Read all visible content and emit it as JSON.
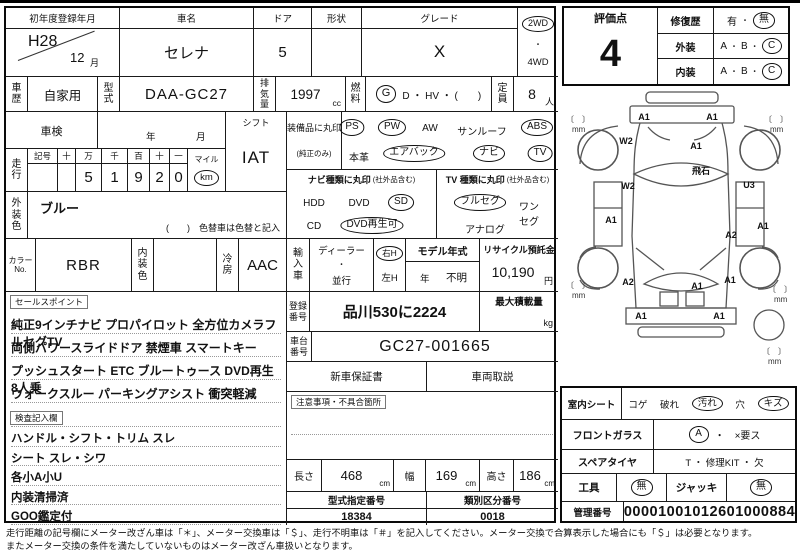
{
  "header": {
    "reg_label": "初年度登録年月",
    "reg_year": "H28",
    "reg_month": "12",
    "reg_month_unit": "月",
    "name_label": "車名",
    "name": "セレナ",
    "door_label": "ドア",
    "door": "5",
    "shape_label": "形状",
    "shape": "",
    "grade_label": "グレード",
    "grade": "X",
    "drive_top": "2WD",
    "drive_sep": "・",
    "drive_bottom": "4WD"
  },
  "row2": {
    "history_label": "車歴",
    "history": "自家用",
    "model_code_label": "型式",
    "model_code": "DAA-GC27",
    "displacement_label": "排気量",
    "displacement": "1997",
    "displacement_unit": "cc",
    "fuel_label": "燃料",
    "fuel_marked": "G",
    "fuel_rest": "D ・ HV ・ (　　)",
    "capacity_label": "定員",
    "capacity": "8",
    "capacity_unit": "人"
  },
  "inspection": {
    "label": "車検",
    "year_unit": "年",
    "month_unit": "月"
  },
  "shift": {
    "label": "シフト",
    "value": "IAT"
  },
  "mileage": {
    "label": "走行",
    "headers": [
      "記号",
      "十",
      "万",
      "千",
      "百",
      "十",
      "一"
    ],
    "digits": [
      "",
      "",
      "5",
      "1",
      "9",
      "2",
      "0"
    ],
    "mile_label": "マイル",
    "km_label": "km"
  },
  "body_color": {
    "label": "外装色",
    "value": "ブルー",
    "note": "(　　)　色替車は色替と記入"
  },
  "color_row": {
    "color_no_label": "カラーNo.",
    "color_no": "RBR",
    "interior_label": "内装色",
    "interior": "",
    "ac_label": "冷房",
    "ac": "AAC"
  },
  "equipment": {
    "label": "装備品に丸印",
    "label_note": "(純正のみ)",
    "row1": [
      {
        "label": "PS",
        "marked": true
      },
      {
        "label": "PW",
        "marked": true
      },
      {
        "label": "AW",
        "marked": false
      },
      {
        "label": "サンルーフ",
        "marked": false
      },
      {
        "label": "ABS",
        "marked": true
      }
    ],
    "row2": [
      {
        "label": "本革",
        "marked": false
      },
      {
        "label": "エアバック",
        "marked": true
      },
      {
        "label": "ナビ",
        "marked": true
      },
      {
        "label": "TV",
        "marked": true
      }
    ]
  },
  "navi": {
    "label": "ナビ種類に丸印",
    "note": "(社外品含む)",
    "row1": [
      {
        "label": "HDD",
        "marked": false
      },
      {
        "label": "DVD",
        "marked": false
      },
      {
        "label": "SD",
        "marked": true
      }
    ],
    "row2": [
      {
        "label": "CD",
        "marked": false
      },
      {
        "label": "DVD再生可",
        "marked": true
      }
    ]
  },
  "tv": {
    "label": "TV 種類に丸印",
    "note": "(社外品含む)",
    "row1": [
      {
        "label": "フルセグ",
        "marked": true
      },
      {
        "label": "ワンセグ",
        "marked": false
      }
    ],
    "row2": [
      {
        "label": "アナログ",
        "marked": false
      }
    ]
  },
  "import_car": {
    "label": "輸入車",
    "dealer": "ディーラー",
    "sep": "・",
    "parallel": "並行",
    "rh": "右H",
    "lh": "左H",
    "model_year_label": "モデル年式",
    "model_year_unit": "年",
    "model_year_value": "不明",
    "recycle_label": "リサイクル預託金",
    "recycle_value": "10,190",
    "recycle_unit": "円"
  },
  "registration": {
    "label": "登録番号",
    "value": "品川530に2224",
    "max_load_label": "最大積載量",
    "max_load_unit": "kg"
  },
  "chassis": {
    "label": "車台番号",
    "value": "GC27-001665"
  },
  "documents": {
    "warranty": "新車保証書",
    "manual": "車両取説"
  },
  "notes": {
    "label": "注意事項・不具合箇所"
  },
  "sales_points": {
    "label": "セールスポイント",
    "lines": [
      "純正9インチナビ プロパイロット 全方位カメラフルセグTV",
      "両側パワースライドドア 禁煙車 スマートキー",
      "プッシュスタート ETC ブルートゥース DVD再生 8人乗",
      "ウォークスルー パーキングアシスト 衝突軽減"
    ]
  },
  "inspector_notes": {
    "label": "検査記入欄",
    "lines": [
      "ハンドル・シフト・トリム スレ",
      "シート スレ・シワ",
      "各小A小U",
      "内装清掃済",
      "GOO鑑定付"
    ]
  },
  "dimensions": {
    "length_label": "長さ",
    "length": "468",
    "width_label": "幅",
    "width": "169",
    "height_label": "高さ",
    "height": "186",
    "unit": "cm"
  },
  "type_numbers": {
    "type_label": "型式指定番号",
    "type_value": "18384",
    "class_label": "類別区分番号",
    "class_value": "0018"
  },
  "evaluation": {
    "score_label": "評価点",
    "score": "4",
    "repair_label": "修復歴",
    "repair_yes": "有",
    "sep": "・",
    "repair_no": "無",
    "exterior_label": "外装",
    "interior_label": "内装",
    "grade_a": "A",
    "grade_b": "B",
    "grade_c": "C"
  },
  "seat": {
    "label": "室内シート",
    "items": [
      {
        "label": "コゲ",
        "marked": false
      },
      {
        "label": "破れ",
        "marked": false
      },
      {
        "label": "汚れ",
        "marked": true
      },
      {
        "label": "穴",
        "marked": false
      },
      {
        "label": "キズ",
        "marked": true
      }
    ]
  },
  "windshield": {
    "label": "フロントガラス",
    "marked": "A",
    "rest": "・　×要ス"
  },
  "spare_tire": {
    "label": "スペアタイヤ",
    "options": "T ・ 修理KIT ・ 欠"
  },
  "tools": {
    "label": "工具",
    "value": "無",
    "jack_label": "ジャッキ",
    "jack_value": "無"
  },
  "management": {
    "label": "管理番号",
    "value": "00001001012601000884"
  },
  "diagram": {
    "bracket": "〔　〕",
    "mm_unit": "mm",
    "front_bumper_left": "A1",
    "front_bumper_right": "A1",
    "front_fender_left": "W2",
    "hood": "A1",
    "windshield": "飛石",
    "side_left": "W2",
    "side_right": "U3",
    "door_left": "A1",
    "side_right_lower": "A1",
    "quarter_right": "A2",
    "quarter_left": "A2",
    "rear_right": "A1",
    "rear_gate": "A1",
    "rear_bumper_left": "A1",
    "rear_bumper_right": "A1"
  },
  "footer": {
    "line1": "走行距離の記号欄にメーター改ざん車は「＊」、メーター交換車は「＄」、走行不明車は「＃」を記入してください。メーター交換で合算表示した場合にも「＄」は必要となります。",
    "line2": "またメーター交換の条件を満たしていないものはメーター改ざん車扱いとなります。"
  }
}
